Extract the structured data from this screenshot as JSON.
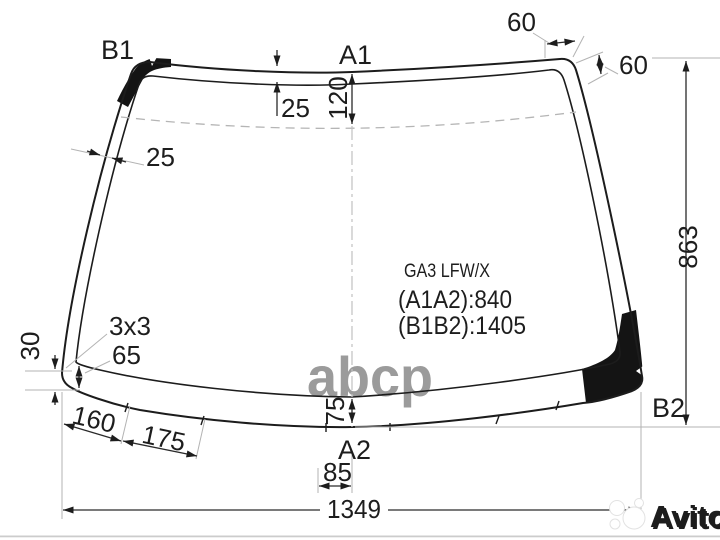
{
  "info": {
    "part_code": "GA3 LFW/X",
    "a1a2": "(A1A2):840",
    "b1b2": "(B1B2):1405"
  },
  "labels": {
    "b1": "B1",
    "a1": "A1",
    "b2": "B2",
    "a2": "A2"
  },
  "dims": {
    "top_corner_width": "60",
    "top_corner_drop": "60",
    "right_height": "863",
    "top_band_width": "25",
    "top_to_fold": "120",
    "left_band_width": "25",
    "corner_mark": "3x3",
    "corner_band": "65",
    "left_offset": "30",
    "seg1": "160",
    "seg2": "175",
    "bottom_band": "75",
    "center_offset": "85",
    "bottom_width": "1349"
  },
  "watermarks": {
    "center": "abcp",
    "brand": "Avito"
  },
  "colors": {
    "line": "#1c1c1c",
    "light_line": "#b3b3b3",
    "watermark_gray": "#9b9b9b"
  }
}
